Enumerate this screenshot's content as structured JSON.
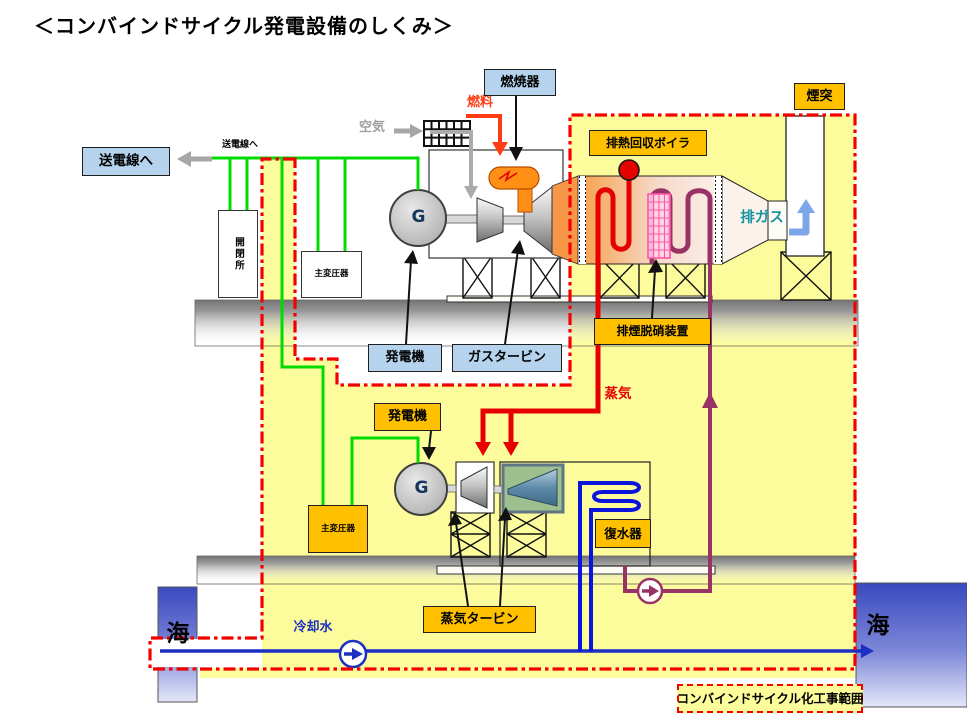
{
  "title": "＜コンバインドサイクル発電設備のしくみ＞",
  "power_transmission": {
    "to_grid_label": "送電線へ",
    "to_grid_small_label": "送電線へ",
    "switchyard": "開閉所",
    "main_transformer_1": "主変圧器"
  },
  "gas_turbine_section": {
    "air": "空気",
    "fuel": "燃料",
    "combustor": "燃焼器",
    "generator": "発電機",
    "generator_tag": "G",
    "gas_turbine": "ガスタービン"
  },
  "hrsg_section": {
    "heat_recovery_boiler": "排熱回収ボイラ",
    "stack": "煙突",
    "exhaust_gas": "排ガス",
    "denox_device": "排煙脱硝装置"
  },
  "steam_section": {
    "steam": "蒸気",
    "generator": "発電機",
    "generator_tag": "G",
    "main_transformer_2": "主変圧器",
    "steam_turbine": "蒸気タービン",
    "condenser": "復水器"
  },
  "cooling_section": {
    "cooling_water": "冷却水",
    "sea_left": "海",
    "sea_right": "海"
  },
  "scope_note": "コンバインドサイクル化工事範囲",
  "colors": {
    "scope_area_yellow": "#FCFC9C",
    "boundary_red": "#F50000",
    "label_blue_fill": "#B5D3EC",
    "label_orange_fill": "#FFC000",
    "wire_green": "#00DC00",
    "steam_red": "#E60000",
    "fuel_red": "#FF3C14",
    "feedwater_purple": "#993366",
    "cooling_blue": "#1B2FC2",
    "exhaust_arrow_blue": "#7DA6E8",
    "exhaust_text_teal": "#1A93A0",
    "air_gray": "#9E9E9E",
    "sea_blue": "#3A49C0"
  }
}
